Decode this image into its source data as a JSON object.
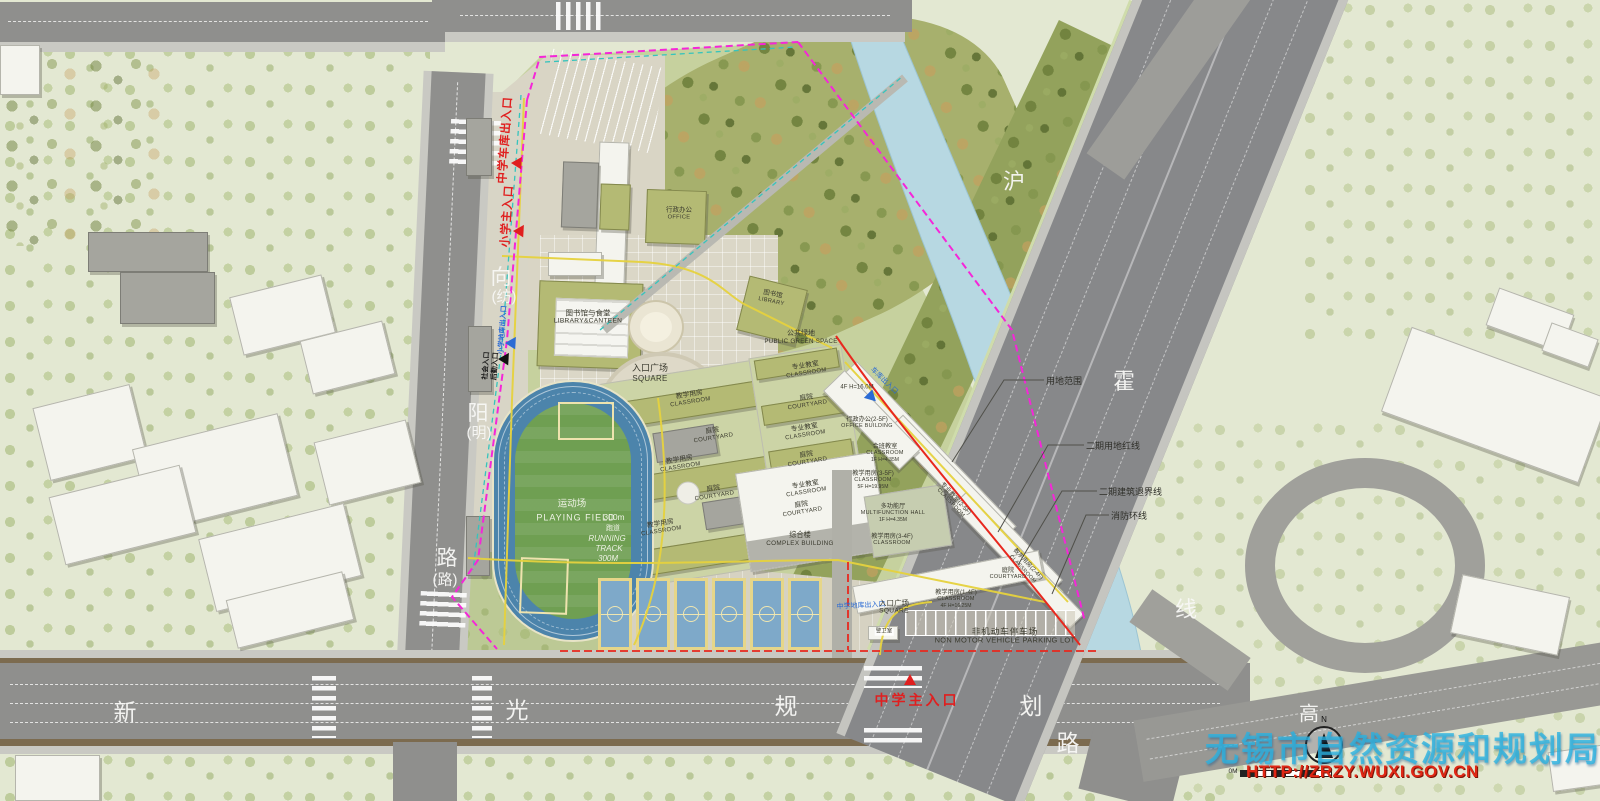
{
  "watermark": {
    "agency": "无锡市自然资源和规划局",
    "url": "HTTP://ZRZY.WUXI.GOV.CN"
  },
  "compass_label": "N",
  "scale_label": "0M",
  "roads": {
    "west": [
      "向",
      "(纺)",
      "阳",
      "(明)",
      "路",
      "(路)"
    ],
    "south": [
      "新",
      "光",
      "规",
      "划",
      "路"
    ],
    "highway": [
      "沪",
      "霍",
      "线"
    ],
    "expressway": "高"
  },
  "entrances": {
    "ms_garage": "中学车库出入口",
    "ps_main": "小学主入口",
    "ps_garage": "小学地库出入口",
    "social": "社会入口",
    "logistics": "后勤入口",
    "ms_main": "中学主入口",
    "ms_basement": "中学地库出入口",
    "ne_garage": "车库出入口"
  },
  "callouts": {
    "site_range": "用地范围",
    "phase2_redline": "二期用地红线",
    "phase2_setback": "二期建筑退界线",
    "fire_ring": "消防环线"
  },
  "field": {
    "zh": "运动场",
    "en": "PLAYING FIELD",
    "length": "300m",
    "track_zh": "跑道",
    "track_en_1": "RUNNING",
    "track_en_2": "TRACK",
    "track_len": "300M"
  },
  "parking": {
    "zh": "非机动车停车场",
    "en": "NON MOTOR VEHICLE PARKING LOT"
  },
  "plan_labels": [
    {
      "zh": "图书馆与食堂",
      "en": "LIBRARY&CANTEEN"
    },
    {
      "zh": "行政办公",
      "en": "OFFICE"
    },
    {
      "zh": "图书馆",
      "en": "LIBRARY"
    },
    {
      "zh": "入口广场",
      "en": "SQUARE"
    },
    {
      "zh": "公共绿地",
      "en": "PUBLIC GREEN SPACE"
    },
    {
      "zh": "教学用房",
      "en": "CLASSROOM"
    },
    {
      "zh": "庭院",
      "en": "COURTYARD"
    },
    {
      "zh": "教学用房",
      "en": "CLASSROOM"
    },
    {
      "zh": "庭院",
      "en": "COURTYARD"
    },
    {
      "zh": "教学用房",
      "en": "CLASSROOM"
    },
    {
      "zh": "专业教室",
      "en": "CLASSROOM"
    },
    {
      "zh": "庭院",
      "en": "COURTYARD"
    },
    {
      "zh": "专业教室",
      "en": "CLASSROOM"
    },
    {
      "zh": "庭院",
      "en": "COURTYARD"
    },
    {
      "zh": "专业教室",
      "en": "CLASSROOM"
    },
    {
      "zh": "庭院",
      "en": "COURTYARD"
    },
    {
      "zh": "综合楼",
      "en": "COMPLEX BUILDING"
    },
    {
      "zh": "多功能厅",
      "en": "MULTIFUNCTION HALL",
      "note": "1F H=4.35M"
    },
    {
      "zh": "行政办公(2-5F)",
      "en": "OFFICE BUILDING"
    },
    {
      "zh": "合班教室",
      "en": "CLASSROOM",
      "note": "1F H=4.35M"
    },
    {
      "zh": "教学用房(3-5F)",
      "en": "CLASSROOM",
      "note": "5F H=19.95M"
    },
    {
      "zh": "教学用房(3-4F)",
      "en": "CLASSROOM"
    },
    {
      "zh": "专业教室(2-5F)",
      "en": "CLASSROOM"
    },
    {
      "zh": "教学用房(2-4F)",
      "en": "CLASSROOM"
    },
    {
      "zh": "教学用房(1-4F)",
      "en": "CLASSROOM",
      "note": "4F H=16.25M"
    },
    {
      "zh": "庭院",
      "en": "COURTYARD"
    },
    {
      "zh": "入口广场",
      "en": "SQUARE"
    },
    {
      "zh": "警卫室",
      "en": ""
    },
    {
      "zh": "4F H=16.0M",
      "en": ""
    }
  ],
  "colors": {
    "entrance_red": "#e01f1f",
    "entrance_blue": "#2b6bd4",
    "boundary_magenta": "#f526d8",
    "phase_redline": "#e8281e",
    "teal_line": "#35c4bd",
    "fire_lane_yellow": "#e6d23e",
    "river": "#b7d8e2",
    "watermark_cyan": "#29b2e2"
  }
}
